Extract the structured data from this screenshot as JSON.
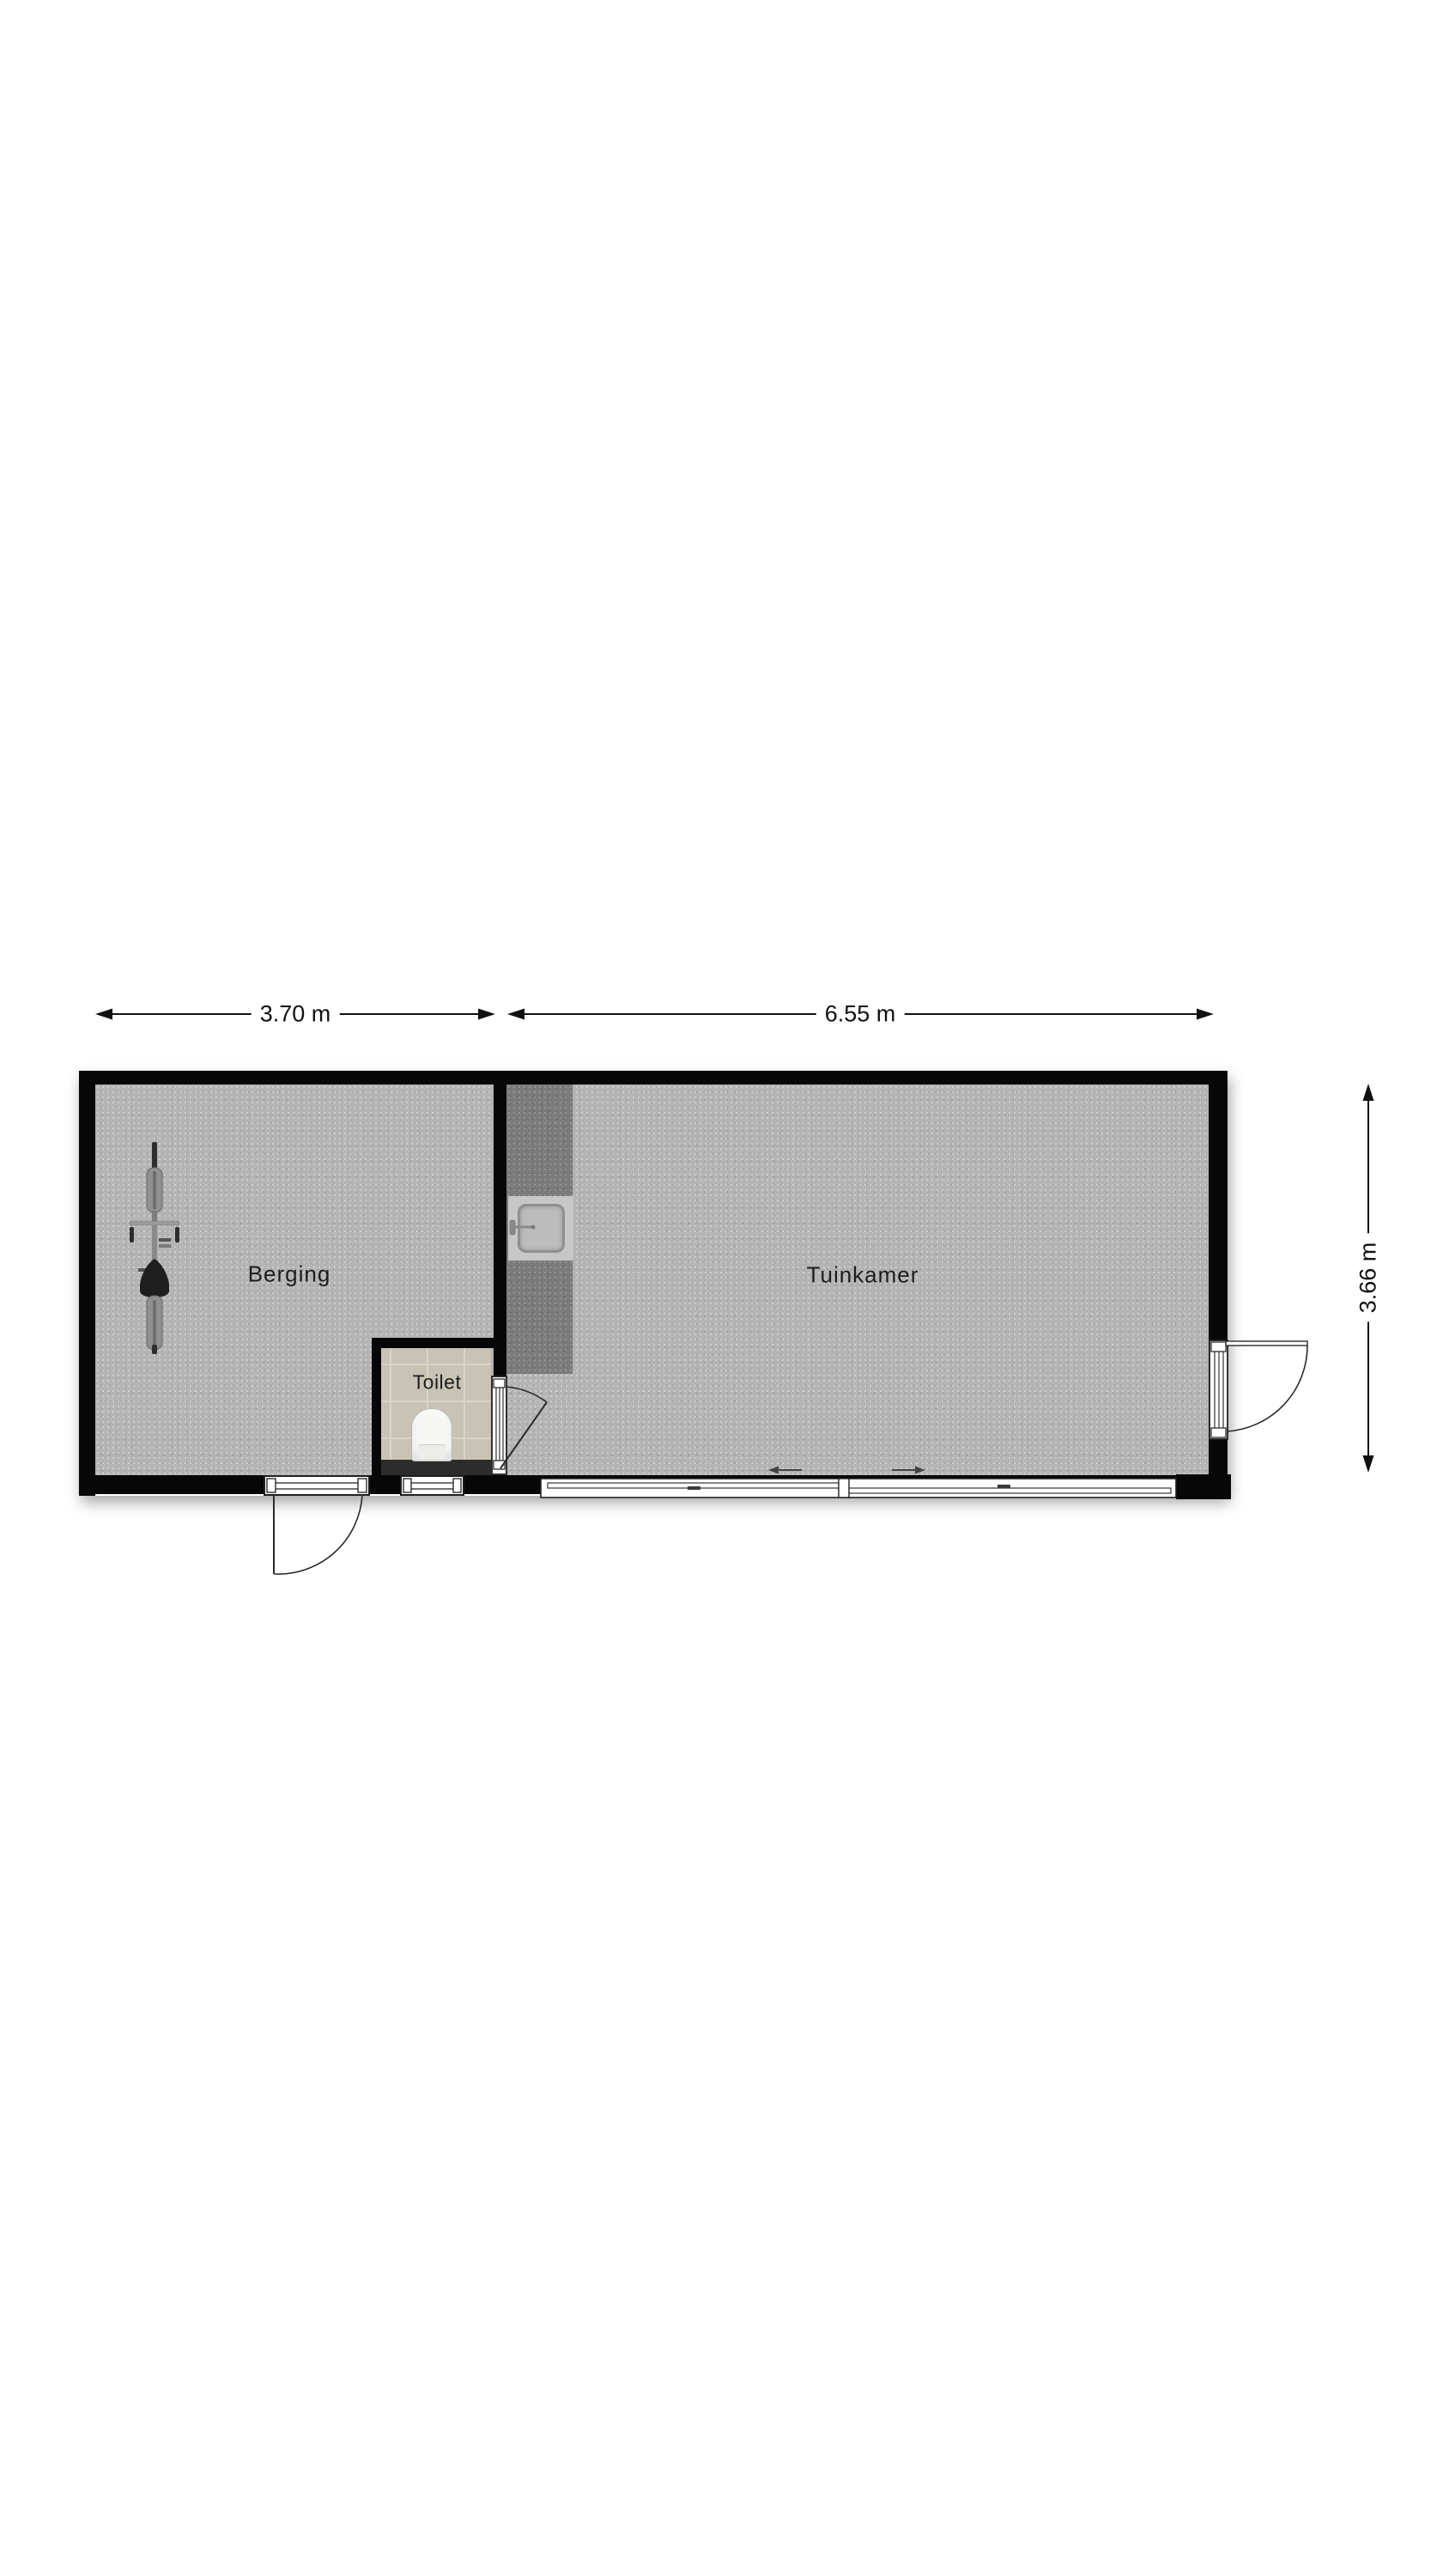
{
  "document": {
    "type": "floor-plan"
  },
  "rooms": {
    "berging": "Berging",
    "tuinkamer": "Tuinkamer",
    "toilet": "Toilet"
  },
  "dimensions": {
    "berging_width": "3.70 m",
    "tuinkamer_width": "6.55 m",
    "building_depth": "3.66 m"
  },
  "fixtures": {
    "bicycle": "bicycle-icon",
    "kitchen_sink": "sink-icon",
    "toilet_bowl": "toilet-icon",
    "sliding_door_arrows": "slide-direction-arrows"
  },
  "colors": {
    "wall": "#070707",
    "floor": "#b4b4b4",
    "counter": "#7b7b7b",
    "toilet_floor": "#c9c3b5",
    "toilet_plinth": "#2c2c2c",
    "background": "#ffffff",
    "line": "#1f1f1f"
  }
}
